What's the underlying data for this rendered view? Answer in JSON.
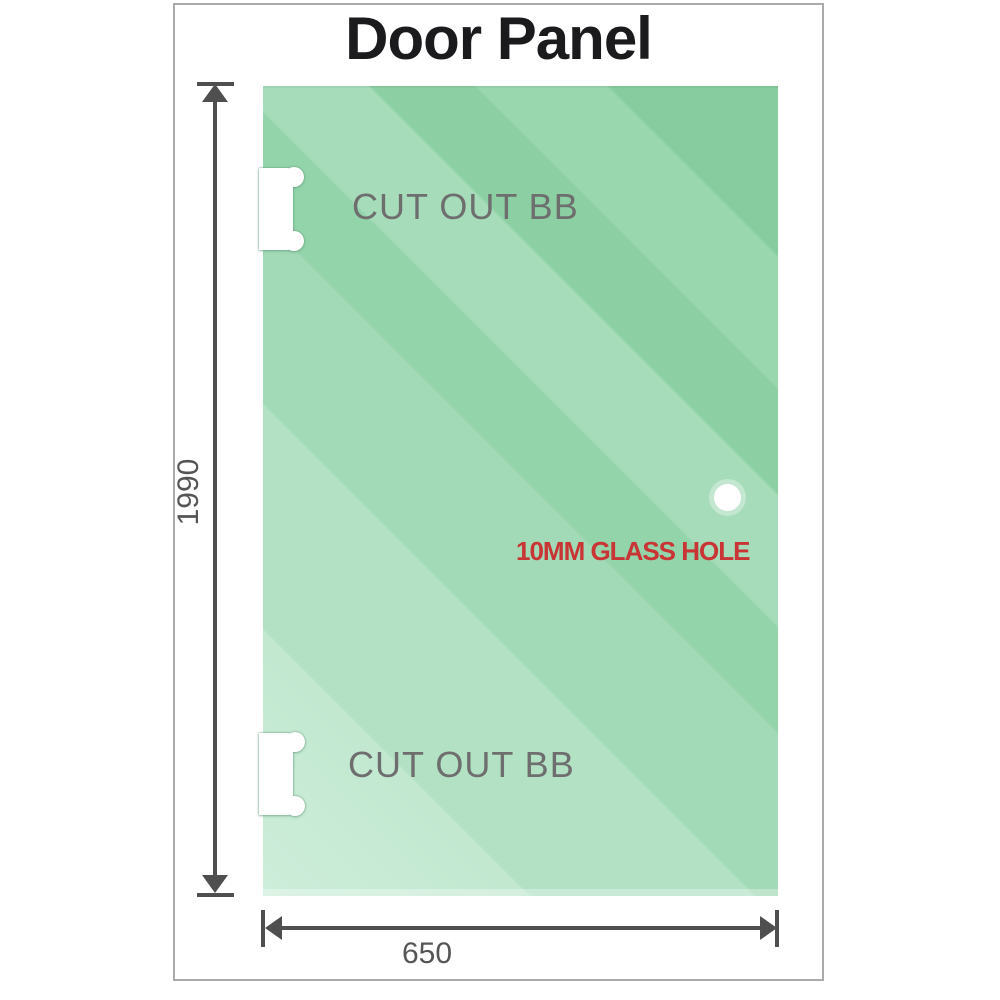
{
  "title": "Door Panel",
  "diagram": {
    "height_dimension": "1990",
    "width_dimension": "650",
    "cutouts": [
      {
        "label": "CUT OUT BB"
      },
      {
        "label": "CUT OUT BB"
      }
    ],
    "hole_label": "10MM GLASS HOLE"
  },
  "colors": {
    "glass_dark": "#86cc9f",
    "glass_light": "#cdeeda",
    "dim": "#4f4f4f",
    "label_gray": "#6e6e6e",
    "red": "#c93434",
    "border_gray": "#aaaaaa",
    "title_black": "#1b1b1e"
  }
}
